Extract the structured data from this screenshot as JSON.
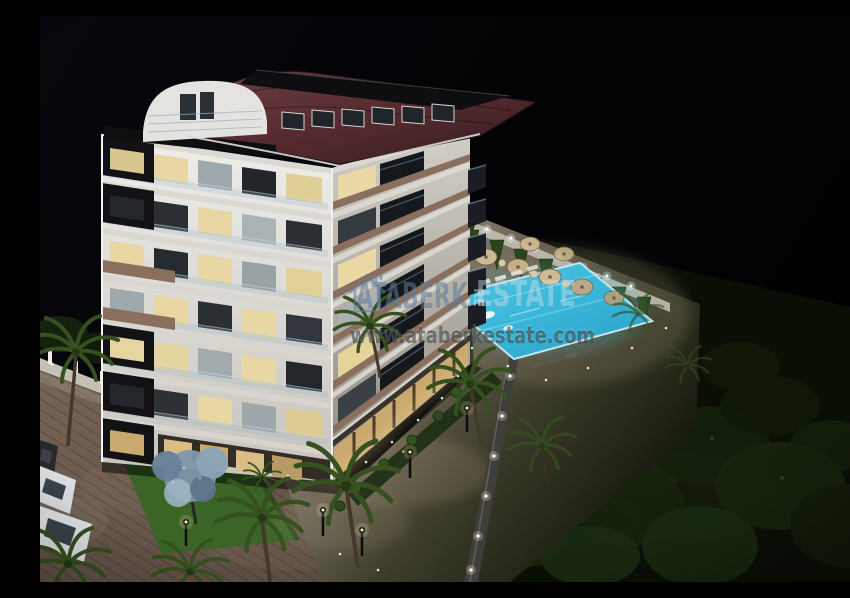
{
  "meta": {
    "type": "architectural-night-render",
    "subject": "Aerial 3D render of a residential apartment block with pool, gardens, palm trees and parked cars at night"
  },
  "watermark": {
    "logo_icon": "house-outline-icon",
    "brand_primary": "ATABERK",
    "brand_secondary": "ESTATE",
    "website": "www.ataberkestate.com",
    "pool_overlay": "RE"
  },
  "palette": {
    "sky": "#04050a",
    "facade_light": "#e9e7e2",
    "facade_shadow": "#b5b1a9",
    "roof_tile": "#54292e",
    "accent_black": "#121215",
    "balcony_wood": "#8b6f5e",
    "window_warm": "#e8d7a2",
    "pool_water": "#38b6da",
    "pool_deep": "#1f8fb5",
    "lawn": "#44722d",
    "street": "#6e5c50",
    "foliage_dark": "#121c0a",
    "watermark_blue": "#5e7a99",
    "watermark_light": "#cfdbe4",
    "watermark_gray": "#3f4347"
  }
}
